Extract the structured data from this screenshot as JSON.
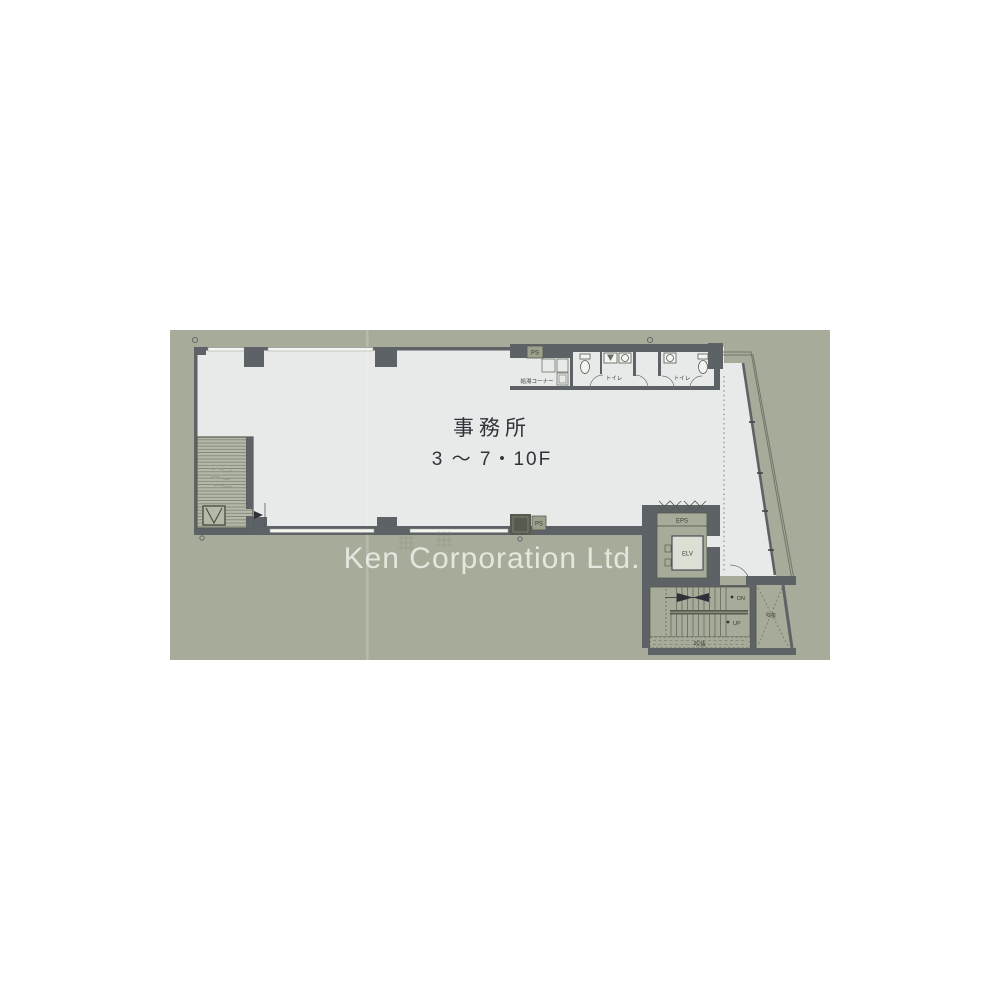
{
  "plan": {
    "room_label": "事務所",
    "floor_range_label": "3 ～ 7・10F",
    "watermark": "Ken Corporation Ltd.",
    "labels": {
      "kitchen": "給湯コーナー",
      "toilet_left": "トイレ",
      "toilet_right": "トイレ",
      "ps_top": "PS",
      "ps_bottom": "PS",
      "eps": "EPS",
      "elevator": "ELV",
      "down": "DN",
      "up": "UP",
      "void_stair": "吹抜",
      "void_side": "吹抜"
    },
    "colors": {
      "canvas": "#ffffff",
      "plan_background": "#a7ac9a",
      "floor": "#e8eae9",
      "wall": "#5d6266",
      "label_text": "#33383e",
      "watermark_text": "#f2f4ee"
    }
  }
}
